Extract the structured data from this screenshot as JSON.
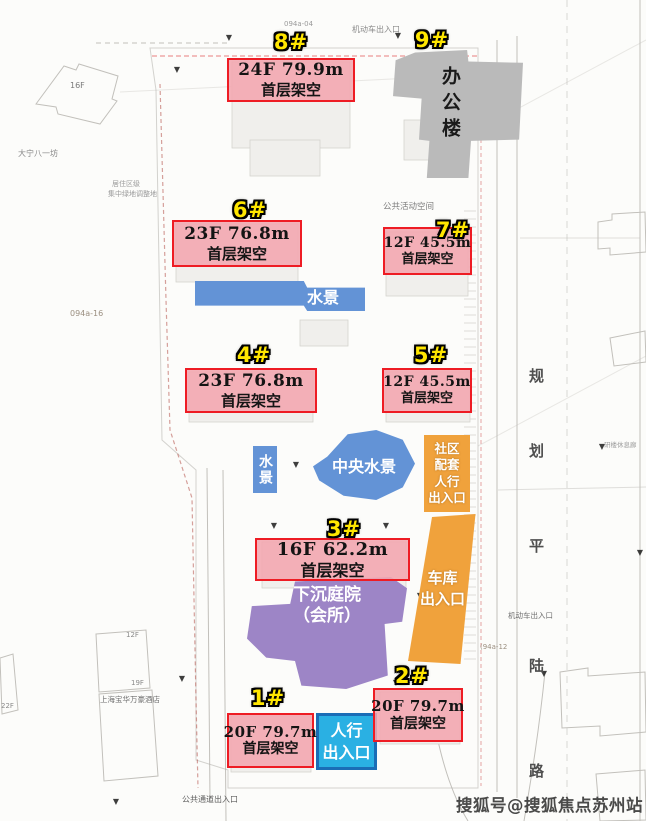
{
  "buildings": {
    "b1": {
      "marker": "1#",
      "floors": "20F 79.7m",
      "podium": "首层架空"
    },
    "b2": {
      "marker": "2#",
      "floors": "20F 79.7m",
      "podium": "首层架空"
    },
    "b3": {
      "marker": "3#",
      "floors": "16F 62.2m",
      "podium": "首层架空"
    },
    "b4": {
      "marker": "4#",
      "floors": "23F 76.8m",
      "podium": "首层架空"
    },
    "b5": {
      "marker": "5#",
      "floors": "12F 45.5m",
      "podium": "首层架空"
    },
    "b6": {
      "marker": "6#",
      "floors": "23F 76.8m",
      "podium": "首层架空"
    },
    "b7": {
      "marker": "7#",
      "floors": "12F 45.5m",
      "podium": "首层架空"
    },
    "b8": {
      "marker": "8#",
      "floors": "24F 79.9m",
      "podium": "首层架空"
    },
    "b9": {
      "marker": "9#"
    }
  },
  "office": {
    "label": "办公楼"
  },
  "water": {
    "strip": "水景",
    "pond": "水景",
    "central": "中央水景"
  },
  "entrances": {
    "pedestrian": {
      "l1": "人行",
      "l2": "出入口"
    },
    "community": {
      "l1": "社区",
      "l2": "配套",
      "l3": "人行",
      "l4": "出入口"
    },
    "garage": {
      "l1": "车库",
      "l2": "出入口"
    }
  },
  "clubhouse": {
    "l1": "下沉庭院",
    "l2": "（会所）"
  },
  "road": {
    "c0": "规",
    "c1": "划",
    "c2": "平",
    "c3": "陆",
    "c4": "路"
  },
  "watermark": "搜狐号@搜狐焦点苏州站",
  "bg": {
    "plot_top": "094a-04",
    "plot_left": "094a-16",
    "plot_right": "(94a-12",
    "motor_top": "机动车出入口",
    "motor_right": "机动车出入口",
    "public_space": "公共活动空间",
    "neighborhood": "大宁八一坊",
    "green1": "居住区级",
    "green2": "集中绿地调整地",
    "f16": "16F",
    "f12": "12F",
    "f19": "19F",
    "f22": "22F",
    "hotel": "上海宝华万豪酒店",
    "passage": "公共通道出入口",
    "rest": "研楼休息廊"
  }
}
